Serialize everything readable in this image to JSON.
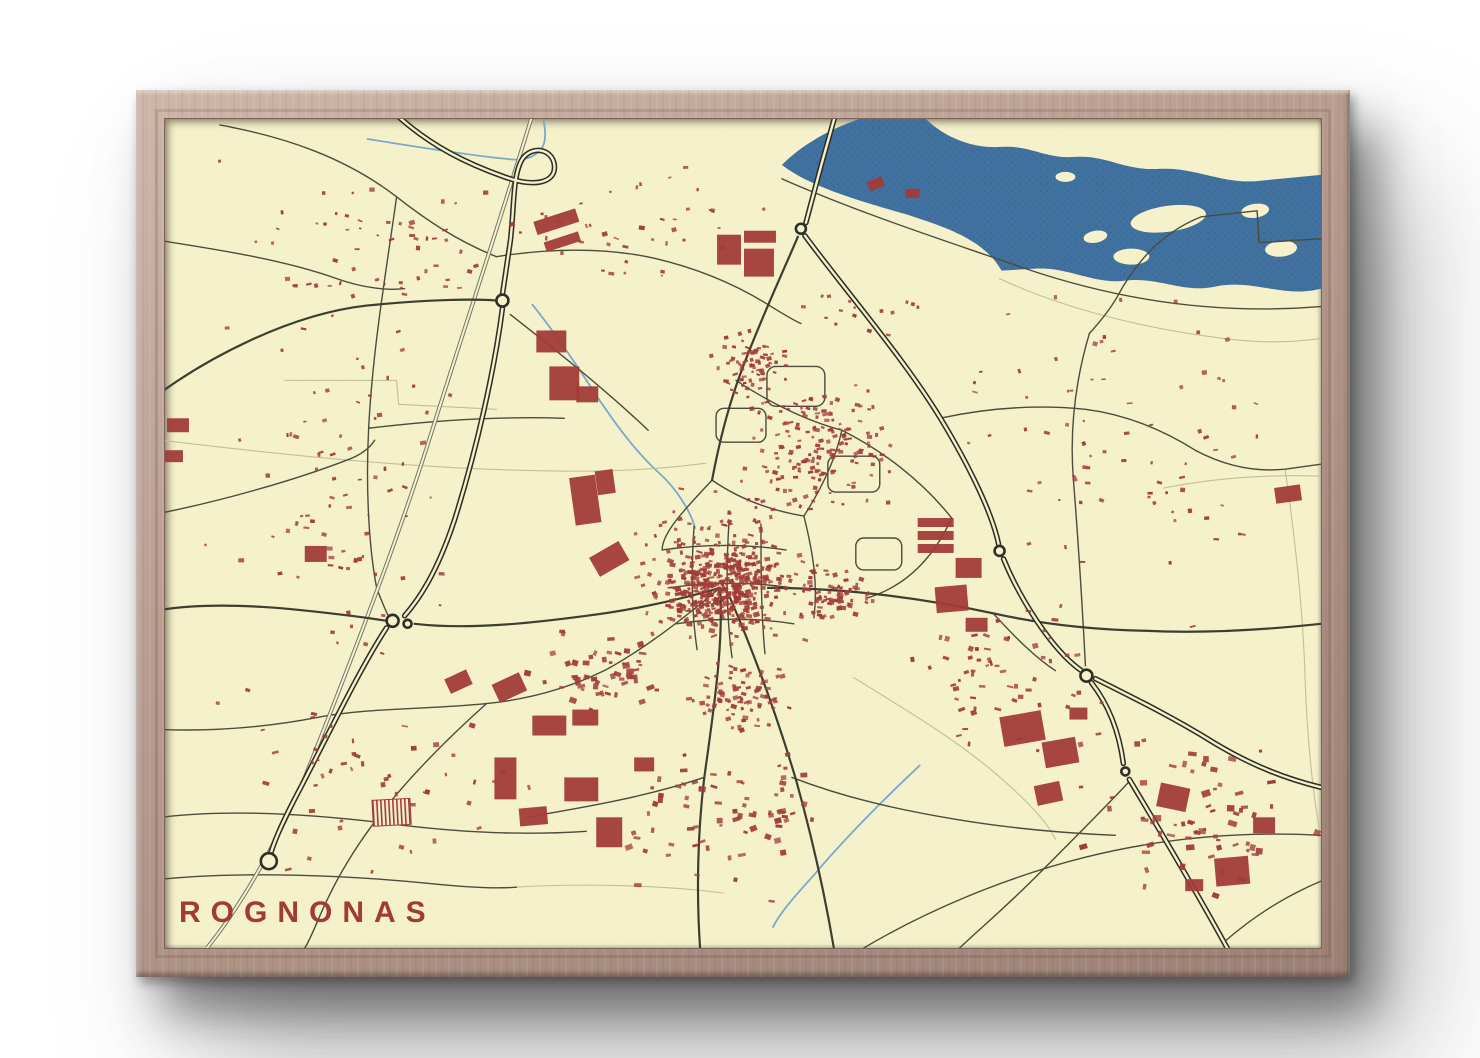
{
  "poster": {
    "title": "ROGNONAS"
  },
  "map": {
    "colors": {
      "background": "#f5f1cb",
      "water": "#40719f",
      "water-speck": "#2c547d",
      "building": "#a23b38",
      "road-major": "#2e2f26",
      "road-medium": "#3c3e30",
      "road-minor": "#4a4c3c",
      "railway": "#75756a",
      "stream": "#79a8cc",
      "field-path": "#c2bf97",
      "title": "#a23a36",
      "wood-light": "#cdb6a8",
      "wood-mid": "#b69a8c",
      "wood-dark": "#9d8175"
    },
    "water": {
      "river": "M 618,46 C 640,24 668,10 690,2 L 700,-2 L 760,-2 C 780,18 808,30 838,28 C 868,26 880,40 912,38 C 944,36 960,52 996,50 C 1032,48 1060,66 1096,62 L 1158,56 L 1158,170 C 1120,180 1090,160 1052,168 C 1020,175 995,158 962,162 C 930,166 905,148 872,150 L 838,152 C 820,120 780,108 744,96 C 710,86 648,70 618,46 Z",
      "islands": [
        [
          1005,
          100,
          38,
          13,
          -8
        ],
        [
          1092,
          92,
          14,
          7,
          -8
        ],
        [
          932,
          118,
          12,
          6,
          -10
        ],
        [
          1118,
          130,
          16,
          8,
          -5
        ],
        [
          968,
          138,
          18,
          8,
          0
        ],
        [
          902,
          58,
          10,
          5,
          0
        ]
      ],
      "streams": [
        "M 203,20 C 252,28 302,36 342,40 C 357,42 369,40 377,30 C 383,22 381,6 377,-6",
        "M 368,186 C 392,216 412,246 430,274 C 450,304 470,332 494,354 C 512,370 526,392 531,410",
        "M 756,648 C 720,682 680,722 650,758 C 630,780 616,796 609,810"
      ]
    },
    "railway": "M 368,-4 C 330,120 290,240 262,330 C 230,430 180,560 140,660 C 110,730 75,790 42,831",
    "roads": {
      "major": [
        "M 230,-6 C 266,28 306,46 340,58 C 374,70 392,62 390,46 C 388,30 368,26 358,40 C 348,56 350,88 346,122 L 338,176",
        "M 338,190 C 330,252 312,332 290,402 C 272,456 254,482 240,498",
        "M 222,510 C 198,546 166,612 136,670 C 120,700 110,722 106,736",
        "M 672,-6 L 658,44 L 642,104",
        "M 641,117 C 680,170 742,242 778,302 C 802,342 828,392 835,426",
        "M 840,441 C 856,480 888,532 918,553",
        "M 928,565 C 946,588 956,616 960,646",
        "M 966,662 C 990,702 1032,772 1064,831",
        "M 932,561 C 972,581 1012,601 1052,626 C 1092,650 1126,662 1158,670"
      ],
      "medium": [
        "M -4,274 C 40,242 122,196 202,187 C 262,181 312,180 332,182",
        "M -4,492 C 60,482 140,492 202,500 L 222,503",
        "M 250,506 C 302,512 362,506 422,498 C 472,492 522,480 556,470",
        "M 556,470 C 560,530 548,602 540,662 C 534,712 532,772 536,831",
        "M 566,480 C 592,540 614,602 632,662 C 646,712 660,772 670,831",
        "M 634,118 C 616,160 592,212 574,262 C 562,296 554,330 548,362",
        "M 604,470 C 682,470 762,481 832,496 C 882,507 932,512 982,513 C 1042,516 1102,512 1158,506"
      ],
      "minor": [
        "M 55,6 C 120,18 180,38 232,78 C 260,100 292,122 332,138",
        "M 232,78 C 222,150 208,230 204,310 C 201,368 204,428 212,470",
        "M -4,122 C 60,132 122,142 172,160 C 200,170 225,172 240,170",
        "M 332,138 C 382,130 440,128 492,140 C 534,150 572,166 604,186 C 620,196 630,202 637,205",
        "M 346,196 C 392,232 442,272 484,312",
        "M -4,395 C 60,382 130,362 182,342 C 196,337 205,330 210,322",
        "M 204,310 C 270,302 340,298 400,300",
        "M 212,470 C 218,486 222,496 226,502",
        "M 548,362 C 522,390 498,414 498,432",
        "M 498,432 C 540,426 582,426 622,432",
        "M 504,470 C 546,464 588,464 628,470",
        "M 512,506 C 552,500 592,500 630,506",
        "M 530,408 C 527,450 527,492 533,532",
        "M 565,404 C 562,450 562,496 568,540",
        "M 597,406 C 597,450 597,494 601,536",
        "M 548,362 C 574,380 604,392 640,398",
        "M 572,262 C 602,282 640,302 678,312",
        "M 640,398 C 658,370 672,340 678,312",
        "M 678,312 C 718,332 758,362 788,400",
        "M 788,400 C 770,440 742,468 704,480",
        "M 640,398 C 650,438 654,468 650,500",
        "M 612,248 h40 a9 9 0 0 1 9 9 v22 a9 9 0 0 1 -9 9 h-40 a9 9 0 0 1 -9 -9 v-22 a9 9 0 0 1 9 -9 Z",
        "M 672,338 h36 a8 8 0 0 1 8 8 v20 a8 8 0 0 1 -8 8 h-36 a8 8 0 0 1 -8 -8 v-20 a8 8 0 0 1 8 -8 Z",
        "M 560,290 h34 a8 8 0 0 1 8 8 v18 a8 8 0 0 1 -8 8 h-34 a8 8 0 0 1 -8 -8 v-18 a8 8 0 0 1 8 -8 Z",
        "M 700,420 h30 a8 8 0 0 1 8 8 v16 a8 8 0 0 1 -8 8 h-30 a8 8 0 0 1 -8 -8 v-16 a8 8 0 0 1 8 -8 Z",
        "M 556,470 C 520,500 482,530 442,552 C 402,572 362,582 322,586 C 264,592 204,590 152,600 C 100,610 50,614 -4,612",
        "M 322,586 C 282,622 242,662 212,702 C 186,736 166,772 152,806 C 146,820 142,828 140,831",
        "M 540,660 C 480,680 420,690 362,700",
        "M 628,660 C 680,680 732,692 792,702 C 852,712 902,716 952,718",
        "M 967,663 C 940,692 906,726 872,760 C 842,790 816,812 796,831",
        "M 700,831 C 762,794 842,760 922,740 C 1002,720 1082,714 1158,718",
        "M 926,215 C 912,262 906,312 910,362 C 913,400 918,470 922,548",
        "M 1158,120 L 1096,124 L 1094,92 L 1038,98 C 998,114 972,144 954,178 C 946,192 936,204 926,215",
        "M 776,300 C 822,290 872,286 922,291 C 962,296 1000,312 1032,332 C 1062,348 1092,354 1122,351 L 1158,346",
        "M 830,496 C 852,520 872,540 892,553",
        "M -4,700 C 60,692 140,696 222,706 C 300,716 362,718 422,714",
        "M -4,762 C 80,754 180,758 262,766 C 300,770 330,772 352,770",
        "M 618,60 C 700,96 782,122 862,150 C 962,184 1062,196 1158,188",
        "M 1062,824 C 1090,800 1120,780 1158,764"
      ]
    },
    "field_paths": [
      "M -4,322 C 80,332 200,346 322,351 C 422,355 482,353 542,345",
      "M 120,262 L 232,262 L 234,286 L 332,291",
      "M 690,560 C 742,592 792,622 832,656 C 862,682 882,702 892,722",
      "M 836,160 C 900,190 980,210 1060,220 C 1100,225 1130,224 1158,220",
      "M 350,770 C 420,766 500,768 560,776",
      "M 1000,370 C 1050,360 1100,356 1158,358",
      "M 1122,351 C 1132,420 1140,490 1142,560 C 1144,620 1150,680 1158,720"
    ],
    "roundabouts": [
      [
        338,
        182,
        6
      ],
      [
        637,
        110,
        5
      ],
      [
        836,
        433,
        5
      ],
      [
        923,
        558,
        6
      ],
      [
        962,
        654,
        4
      ],
      [
        228,
        503,
        6
      ],
      [
        243,
        506,
        4
      ],
      [
        104,
        744,
        8
      ]
    ],
    "buildings": {
      "large": [
        [
          370,
          96,
          44,
          14,
          -18
        ],
        [
          380,
          118,
          36,
          10,
          -18
        ],
        [
          372,
          212,
          30,
          22,
          0
        ],
        [
          385,
          248,
          30,
          34,
          0
        ],
        [
          412,
          268,
          22,
          16,
          0
        ],
        [
          408,
          358,
          26,
          48,
          -8
        ],
        [
          432,
          352,
          18,
          24,
          -8
        ],
        [
          428,
          430,
          34,
          22,
          -30
        ],
        [
          553,
          116,
          24,
          30,
          0
        ],
        [
          580,
          112,
          32,
          12,
          0
        ],
        [
          580,
          130,
          30,
          28,
          0
        ],
        [
          754,
          400,
          36,
          9,
          0
        ],
        [
          754,
          413,
          36,
          9,
          0
        ],
        [
          754,
          426,
          36,
          9,
          0
        ],
        [
          792,
          440,
          26,
          20,
          0
        ],
        [
          772,
          468,
          32,
          26,
          -5
        ],
        [
          802,
          500,
          22,
          14,
          0
        ],
        [
          1112,
          368,
          26,
          16,
          -8
        ],
        [
          368,
          598,
          34,
          20,
          0
        ],
        [
          408,
          592,
          26,
          16,
          0
        ],
        [
          330,
          640,
          22,
          42,
          0
        ],
        [
          355,
          690,
          28,
          18,
          -5
        ],
        [
          400,
          660,
          34,
          24,
          0
        ],
        [
          432,
          700,
          26,
          30,
          0
        ],
        [
          470,
          640,
          20,
          14,
          0
        ],
        [
          330,
          560,
          30,
          20,
          -25
        ],
        [
          282,
          556,
          24,
          16,
          -25
        ],
        [
          838,
          596,
          42,
          30,
          -10
        ],
        [
          880,
          622,
          34,
          26,
          -10
        ],
        [
          906,
          590,
          18,
          12,
          0
        ],
        [
          872,
          666,
          26,
          20,
          -12
        ],
        [
          995,
          668,
          30,
          24,
          12
        ],
        [
          1052,
          740,
          34,
          28,
          -5
        ],
        [
          1090,
          700,
          22,
          16,
          0
        ],
        [
          1022,
          762,
          18,
          12,
          0
        ],
        [
          2,
          300,
          22,
          14,
          0
        ],
        [
          0,
          332,
          18,
          12,
          0
        ],
        [
          140,
          428,
          22,
          16,
          0
        ],
        [
          704,
          60,
          16,
          10,
          -20
        ],
        [
          742,
          70,
          14,
          9,
          0
        ]
      ],
      "greenhouse": [
        208,
        682,
        38,
        26,
        -3
      ],
      "clusters": [
        {
          "x": 560,
          "y": 468,
          "rx": 80,
          "ry": 62,
          "n": 300,
          "s0": 2.5,
          "s1": 6.5,
          "seed": 11
        },
        {
          "x": 558,
          "y": 452,
          "rx": 122,
          "ry": 100,
          "n": 190,
          "s0": 2.5,
          "s1": 6,
          "seed": 12
        },
        {
          "x": 652,
          "y": 330,
          "rx": 95,
          "ry": 75,
          "n": 170,
          "s0": 2.5,
          "s1": 5.5,
          "seed": 13
        },
        {
          "x": 585,
          "y": 245,
          "rx": 52,
          "ry": 48,
          "n": 70,
          "s0": 2.5,
          "s1": 5.5,
          "seed": 14
        },
        {
          "x": 668,
          "y": 478,
          "rx": 55,
          "ry": 42,
          "n": 70,
          "s0": 2.5,
          "s1": 6,
          "seed": 15
        },
        {
          "x": 575,
          "y": 575,
          "rx": 65,
          "ry": 48,
          "n": 80,
          "s0": 2.5,
          "s1": 6,
          "seed": 16
        },
        {
          "x": 430,
          "y": 555,
          "rx": 85,
          "ry": 55,
          "n": 55,
          "s0": 3,
          "s1": 8,
          "seed": 17
        },
        {
          "x": 175,
          "y": 370,
          "rx": 175,
          "ry": 255,
          "n": 85,
          "s0": 2,
          "s1": 6,
          "seed": 18
        },
        {
          "x": 210,
          "y": 125,
          "rx": 185,
          "ry": 108,
          "n": 55,
          "s0": 2,
          "s1": 6,
          "seed": 19
        },
        {
          "x": 215,
          "y": 668,
          "rx": 200,
          "ry": 100,
          "n": 50,
          "s0": 2,
          "s1": 7,
          "seed": 20
        },
        {
          "x": 560,
          "y": 690,
          "rx": 165,
          "ry": 118,
          "n": 75,
          "s0": 3,
          "s1": 8,
          "seed": 21
        },
        {
          "x": 960,
          "y": 310,
          "rx": 210,
          "ry": 240,
          "n": 80,
          "s0": 2,
          "s1": 6,
          "seed": 22
        },
        {
          "x": 840,
          "y": 560,
          "rx": 125,
          "ry": 95,
          "n": 60,
          "s0": 2.5,
          "s1": 7,
          "seed": 23
        },
        {
          "x": 1030,
          "y": 700,
          "rx": 140,
          "ry": 108,
          "n": 65,
          "s0": 3,
          "s1": 9,
          "seed": 24
        },
        {
          "x": 460,
          "y": 112,
          "rx": 185,
          "ry": 92,
          "n": 40,
          "s0": 2,
          "s1": 6,
          "seed": 25
        },
        {
          "x": 700,
          "y": 180,
          "rx": 120,
          "ry": 60,
          "n": 30,
          "s0": 2,
          "s1": 5,
          "seed": 26
        }
      ]
    }
  }
}
